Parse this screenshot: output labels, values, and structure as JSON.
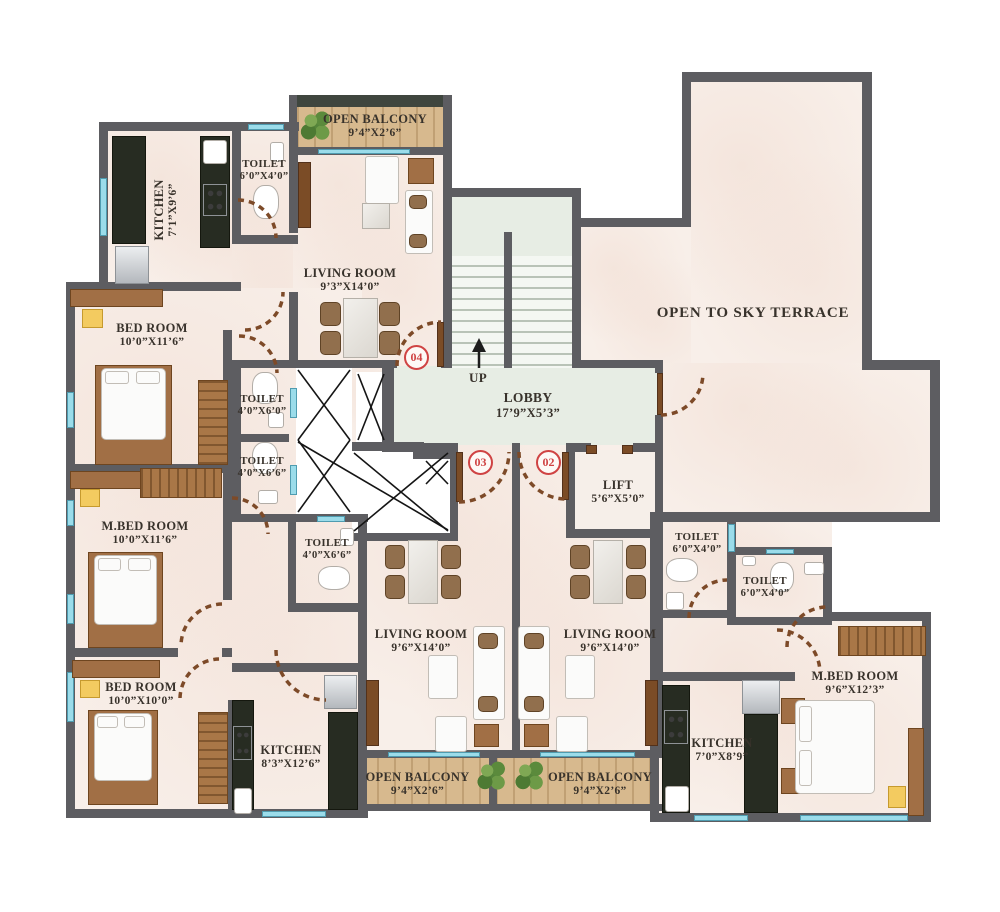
{
  "plan_title": "Floor Plan",
  "colors": {
    "wall": "#5d5d61",
    "floor": "#f8efe9",
    "lobby": "#e7ede4",
    "balcony_wood": "#d7b98e",
    "counter_dark": "#272c22",
    "window_cyan": "#9bdcea",
    "accent_red": "#cf4343",
    "door_arc": "#7d4a28"
  },
  "rooms": {
    "k04": {
      "name": "KITCHEN",
      "dim": "7’1”X9’6”"
    },
    "t04": {
      "name": "TOILET",
      "dim": "6’0”X4’0”"
    },
    "balTop": {
      "name": "OPEN BALCONY",
      "dim": "9’4”X2’6”"
    },
    "liv04": {
      "name": "LIVING ROOM",
      "dim": "9’3”X14’0”"
    },
    "bed04": {
      "name": "BED ROOM",
      "dim": "10’0”X11’6”"
    },
    "tM1": {
      "name": "TOILET",
      "dim": "4’0”X6’0”"
    },
    "tM2": {
      "name": "TOILET",
      "dim": "4’0”X6’6”"
    },
    "mbedL": {
      "name": "M.BED ROOM",
      "dim": "10’0”X11’6”"
    },
    "tM3": {
      "name": "TOILET",
      "dim": "4’0”X6’6”"
    },
    "bed3": {
      "name": "BED ROOM",
      "dim": "10’0”X10’0”"
    },
    "k03": {
      "name": "KITCHEN",
      "dim": "8’3”X12’6”"
    },
    "balBL": {
      "name": "OPEN BALCONY",
      "dim": "9’4”X2’6”"
    },
    "balBR": {
      "name": "OPEN BALCONY",
      "dim": "9’4”X2’6”"
    },
    "liv03": {
      "name": "LIVING ROOM",
      "dim": "9’6”X14’0”"
    },
    "liv02": {
      "name": "LIVING ROOM",
      "dim": "9’6”X14’0”"
    },
    "lobby": {
      "name": "LOBBY",
      "dim": "17’9”X5’3”"
    },
    "lift": {
      "name": "LIFT",
      "dim": "5’6”X5’0”"
    },
    "t01a": {
      "name": "TOILET",
      "dim": "6’0”X4’0”"
    },
    "t01b": {
      "name": "TOILET",
      "dim": "6’0”X4’0”"
    },
    "mbed01": {
      "name": "M.BED ROOM",
      "dim": "9’6”X12’3”"
    },
    "k01": {
      "name": "KITCHEN",
      "dim": "7’0”X8’9”"
    },
    "terrace": {
      "name": "OPEN TO SKY TERRACE",
      "dim": ""
    }
  },
  "labels": {
    "up": "UP"
  },
  "units": {
    "u04": "04",
    "u03": "03",
    "u02": "02"
  }
}
